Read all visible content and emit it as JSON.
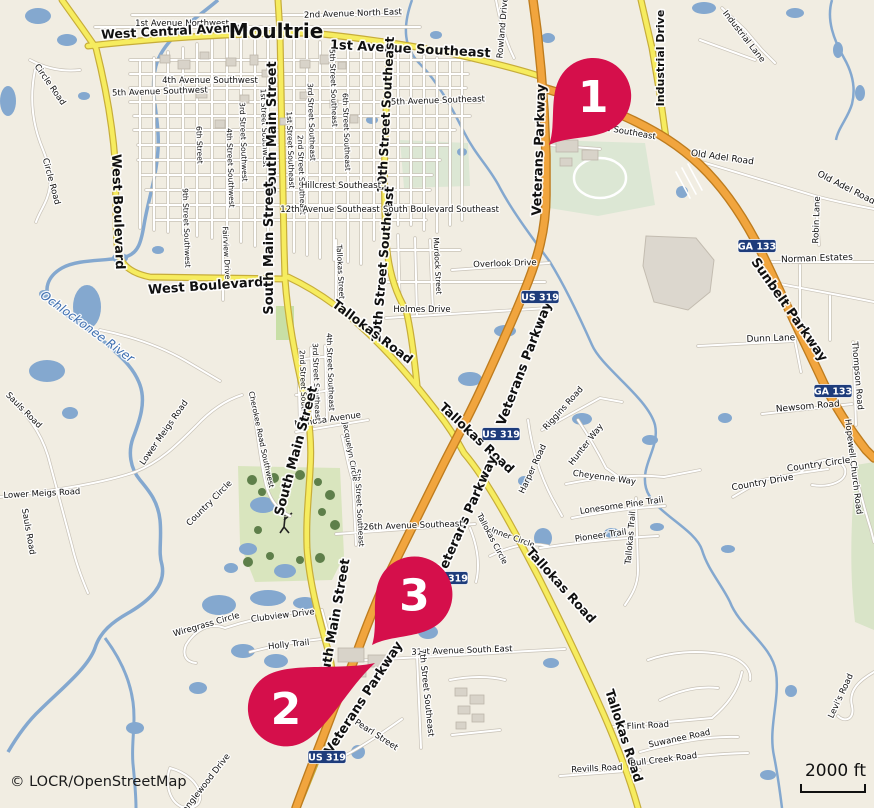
{
  "attribution": "© LOCR/OpenStreetMap",
  "scale": {
    "label": "2000 ft"
  },
  "colors": {
    "land": "#F1EDE2",
    "water": "#84A8CF",
    "road_minor_fill": "#FFFFFF",
    "road_minor_casing": "#C9C3B8",
    "road_secondary_fill": "#F6EC5F",
    "road_secondary_casing": "#C7AD3A",
    "road_trunk_fill": "#F1A53E",
    "road_trunk_casing": "#BE7C1E",
    "green_golf": "#D9E5BE",
    "green_park": "#DCE7D4",
    "tree": "#5E7F4A",
    "building": "#D8D3C9",
    "industrial": "#DCD7CE",
    "shield": "#1E3C7B",
    "marker": "#D50F4B",
    "label_text": "#101010",
    "water_text": "#3D6EB0"
  },
  "markers": [
    {
      "number": "1",
      "tip": [
        549,
        145
      ],
      "rot": 42,
      "len": 66
    },
    {
      "number": "2",
      "tip": [
        375,
        663
      ],
      "rot": -117,
      "len": 100
    },
    {
      "number": "3",
      "tip": [
        372,
        645
      ],
      "rot": 40,
      "len": 66
    }
  ],
  "shields": [
    {
      "label": "US 319",
      "x": 540,
      "y": 297
    },
    {
      "label": "US 319",
      "x": 501,
      "y": 434
    },
    {
      "label": "US 319",
      "x": 449,
      "y": 578
    },
    {
      "label": "US 319",
      "x": 327,
      "y": 757
    },
    {
      "label": "GA 133",
      "x": 757,
      "y": 246
    },
    {
      "label": "GA 133",
      "x": 833,
      "y": 391
    }
  ],
  "road_labels": [
    {
      "t": "1st Avenue Northwest",
      "x": 182,
      "y": 26,
      "r": 0,
      "s": 8.5
    },
    {
      "t": "West Central Avenue",
      "x": 175,
      "y": 35,
      "r": -3,
      "s": 12.5,
      "b": 1
    },
    {
      "t": "Moultrie",
      "x": 276,
      "y": 38,
      "r": 0,
      "s": 20,
      "b": 1,
      "n": "city-label"
    },
    {
      "t": "2nd Avenue North East",
      "x": 353,
      "y": 16,
      "r": -2,
      "s": 8.5
    },
    {
      "t": "1st Avenue Southeast",
      "x": 410,
      "y": 53,
      "r": 3,
      "s": 13,
      "b": 1
    },
    {
      "t": "Rowland Drive",
      "x": 505,
      "y": 28,
      "r": -85,
      "s": 8.5
    },
    {
      "t": "Industrial Drive",
      "x": 664,
      "y": 58,
      "r": -90,
      "s": 11,
      "b": 1
    },
    {
      "t": "Industrial Lane",
      "x": 742,
      "y": 38,
      "r": 52,
      "s": 8.5
    },
    {
      "t": "Old Adel Road",
      "x": 722,
      "y": 160,
      "r": 8,
      "s": 9
    },
    {
      "t": "Old Adel Road",
      "x": 845,
      "y": 190,
      "r": 27,
      "s": 9
    },
    {
      "t": "Robin Lane",
      "x": 819,
      "y": 220,
      "r": -88,
      "s": 8.5
    },
    {
      "t": "Norman Estates",
      "x": 817,
      "y": 261,
      "r": -2,
      "s": 9
    },
    {
      "t": "Sunbelt Parkway",
      "x": 786,
      "y": 312,
      "r": 55,
      "s": 13,
      "b": 1
    },
    {
      "t": "Dunn Lane",
      "x": 771,
      "y": 341,
      "r": -2,
      "s": 9
    },
    {
      "t": "Thompson Road",
      "x": 855,
      "y": 376,
      "r": 85,
      "s": 8.5
    },
    {
      "t": "Newsom Road",
      "x": 808,
      "y": 409,
      "r": -5,
      "s": 9
    },
    {
      "t": "Hopewell Church Road",
      "x": 851,
      "y": 467,
      "r": 83,
      "s": 8.5
    },
    {
      "t": "Country Circle",
      "x": 819,
      "y": 467,
      "r": -8,
      "s": 9
    },
    {
      "t": "Country Drive",
      "x": 763,
      "y": 485,
      "r": -10,
      "s": 9
    },
    {
      "t": "Levi's Road",
      "x": 843,
      "y": 697,
      "r": -65,
      "s": 8.5
    },
    {
      "t": "Circle Road",
      "x": 48,
      "y": 86,
      "r": 55,
      "s": 8.5
    },
    {
      "t": "Circle Road",
      "x": 49,
      "y": 182,
      "r": 75,
      "s": 8.5
    },
    {
      "t": "West Boulevard",
      "x": 114,
      "y": 212,
      "r": 88,
      "s": 13,
      "b": 1
    },
    {
      "t": "West Boulevard",
      "x": 206,
      "y": 290,
      "r": -4,
      "s": 13,
      "b": 1
    },
    {
      "t": "Ochlockonee River",
      "x": 85,
      "y": 330,
      "r": 36,
      "s": 12,
      "c": "#3D6EB0",
      "i": 1,
      "n": "river-label"
    },
    {
      "t": "Sauls Road",
      "x": 22,
      "y": 412,
      "r": 45,
      "s": 8.5
    },
    {
      "t": "Sauls Road",
      "x": 26,
      "y": 532,
      "r": 80,
      "s": 8.5
    },
    {
      "t": "Lower Meigs Road",
      "x": 166,
      "y": 434,
      "r": -55,
      "s": 8.5
    },
    {
      "t": "Lower Meigs Road",
      "x": 42,
      "y": 496,
      "r": -3,
      "s": 8.5
    },
    {
      "t": "Country Circle",
      "x": 211,
      "y": 505,
      "r": -45,
      "s": 8.5
    },
    {
      "t": "1st Street Southwest",
      "x": 262,
      "y": 128,
      "r": 88,
      "s": 7.5
    },
    {
      "t": "3rd Street Southwest",
      "x": 241,
      "y": 142,
      "r": 88,
      "s": 7.5
    },
    {
      "t": "4th Street Southwest",
      "x": 228,
      "y": 168,
      "r": 88,
      "s": 7.5
    },
    {
      "t": "6th Street",
      "x": 197,
      "y": 145,
      "r": 88,
      "s": 7.5
    },
    {
      "t": "9th Street Southwest",
      "x": 184,
      "y": 228,
      "r": 88,
      "s": 7.5
    },
    {
      "t": "1st Street Southeast",
      "x": 288,
      "y": 150,
      "r": 88,
      "s": 7.5
    },
    {
      "t": "2nd Street Southeast",
      "x": 299,
      "y": 175,
      "r": 88,
      "s": 7.5
    },
    {
      "t": "3rd Street Southeast",
      "x": 309,
      "y": 122,
      "r": 88,
      "s": 7.5
    },
    {
      "t": "5th Street Southeast",
      "x": 331,
      "y": 88,
      "r": 88,
      "s": 7.5
    },
    {
      "t": "6th Street Southeast",
      "x": 344,
      "y": 132,
      "r": 88,
      "s": 7.5
    },
    {
      "t": "10th Street Southeast",
      "x": 390,
      "y": 115,
      "r": -87,
      "s": 12.5,
      "b": 1
    },
    {
      "t": "10th Street Southeast",
      "x": 387,
      "y": 265,
      "r": -85,
      "s": 12.5,
      "b": 1
    },
    {
      "t": "South Main Street",
      "x": 276,
      "y": 128,
      "r": -90,
      "s": 13,
      "b": 1
    },
    {
      "t": "South Main Street",
      "x": 273,
      "y": 248,
      "r": -90,
      "s": 13,
      "b": 1
    },
    {
      "t": "4th Avenue Southwest",
      "x": 210,
      "y": 83,
      "r": 0,
      "s": 8.5
    },
    {
      "t": "5th Avenue Southwest",
      "x": 160,
      "y": 94,
      "r": -2,
      "s": 8.5
    },
    {
      "t": "5th Avenue Southeast",
      "x": 438,
      "y": 103,
      "r": -2,
      "s": 8.5
    },
    {
      "t": "Hillcrest Southeast",
      "x": 341,
      "y": 188,
      "r": 0,
      "s": 8.5
    },
    {
      "t": "12th Avenue Southeast",
      "x": 330,
      "y": 212,
      "r": 0,
      "s": 8.5
    },
    {
      "t": "South Boulevard Southeast",
      "x": 441,
      "y": 212,
      "r": 0,
      "s": 8.5
    },
    {
      "t": "nue Southeast",
      "x": 625,
      "y": 134,
      "r": 10,
      "s": 8.5
    },
    {
      "t": "Fairview Drive",
      "x": 224,
      "y": 253,
      "r": 87,
      "s": 7.5
    },
    {
      "t": "Tallokas Street",
      "x": 338,
      "y": 272,
      "r": 87,
      "s": 7.5
    },
    {
      "t": "Murdock Street",
      "x": 435,
      "y": 266,
      "r": 87,
      "s": 7.5
    },
    {
      "t": "Overlook Drive",
      "x": 505,
      "y": 266,
      "r": -2,
      "s": 8.5
    },
    {
      "t": "Holmes Drive",
      "x": 422,
      "y": 312,
      "r": 0,
      "s": 8.5
    },
    {
      "t": "Tallokas Road",
      "x": 370,
      "y": 335,
      "r": 37,
      "s": 12.5,
      "b": 1
    },
    {
      "t": "Veterans Parkway",
      "x": 543,
      "y": 150,
      "r": -88,
      "s": 13,
      "b": 1
    },
    {
      "t": "Veterans Parkway",
      "x": 528,
      "y": 365,
      "r": -69,
      "s": 13,
      "b": 1
    },
    {
      "t": "Tallokas Road",
      "x": 474,
      "y": 441,
      "r": 43,
      "s": 12.5,
      "b": 1
    },
    {
      "t": "Veterans Parkway",
      "x": 470,
      "y": 518,
      "r": -66,
      "s": 13,
      "b": 1
    },
    {
      "t": "Riggins Road",
      "x": 565,
      "y": 410,
      "r": -48,
      "s": 8.5
    },
    {
      "t": "Hunter Way",
      "x": 588,
      "y": 446,
      "r": -52,
      "s": 8.5
    },
    {
      "t": "Cheyenne Way",
      "x": 604,
      "y": 480,
      "r": 8,
      "s": 8.5
    },
    {
      "t": "Harper Road",
      "x": 535,
      "y": 470,
      "r": -65,
      "s": 8.5
    },
    {
      "t": "Lonesome Pine Trail",
      "x": 622,
      "y": 508,
      "r": -8,
      "s": 8.5
    },
    {
      "t": "Pioneer Trail",
      "x": 601,
      "y": 538,
      "r": -8,
      "s": 8.5
    },
    {
      "t": "Tallokas Trail",
      "x": 633,
      "y": 538,
      "r": -85,
      "s": 8.5
    },
    {
      "t": "Inner Circle",
      "x": 512,
      "y": 540,
      "r": 20,
      "s": 8
    },
    {
      "t": "Tallokas Circle",
      "x": 490,
      "y": 540,
      "r": 62,
      "s": 8
    },
    {
      "t": "26th Avenue Southeast",
      "x": 413,
      "y": 528,
      "r": -2,
      "s": 8.5
    },
    {
      "t": "5th Street Southeast",
      "x": 357,
      "y": 508,
      "r": 87,
      "s": 7.5
    },
    {
      "t": "Cherokee Road Southwest",
      "x": 259,
      "y": 440,
      "r": 78,
      "s": 7.5
    },
    {
      "t": "Mimosa Avenue",
      "x": 328,
      "y": 422,
      "r": -8,
      "s": 8.5
    },
    {
      "t": "Jacquelyn Circle",
      "x": 348,
      "y": 452,
      "r": 80,
      "s": 7.5
    },
    {
      "t": "2nd Street Southeast",
      "x": 301,
      "y": 390,
      "r": 88,
      "s": 7.5
    },
    {
      "t": "3rd Street Southeast",
      "x": 314,
      "y": 382,
      "r": 88,
      "s": 7.5
    },
    {
      "t": "4th Street Southeast",
      "x": 328,
      "y": 372,
      "r": 88,
      "s": 7.5
    },
    {
      "t": "South Main Street",
      "x": 300,
      "y": 452,
      "r": -75,
      "s": 13,
      "b": 1
    },
    {
      "t": "South Main Street",
      "x": 338,
      "y": 625,
      "r": -80,
      "s": 13,
      "b": 1
    },
    {
      "t": "Wiregrass Circle",
      "x": 207,
      "y": 627,
      "r": -16,
      "s": 8.5
    },
    {
      "t": "Clubview Drive",
      "x": 283,
      "y": 618,
      "r": -7,
      "s": 8.5
    },
    {
      "t": "Holly Trail",
      "x": 289,
      "y": 647,
      "r": -6,
      "s": 8.5
    },
    {
      "t": "31st Avenue South East",
      "x": 462,
      "y": 653,
      "r": -2,
      "s": 8.5
    },
    {
      "t": "7th Street Southeast",
      "x": 424,
      "y": 693,
      "r": 84,
      "s": 8.5
    },
    {
      "t": "Pearl Street",
      "x": 375,
      "y": 737,
      "r": 33,
      "s": 8.5
    },
    {
      "t": "Veterans Parkway",
      "x": 367,
      "y": 700,
      "r": -57,
      "s": 13,
      "b": 1
    },
    {
      "t": "Tanglewood Drive",
      "x": 207,
      "y": 786,
      "r": -52,
      "s": 8.5
    },
    {
      "t": "Tallokas Road",
      "x": 558,
      "y": 588,
      "r": 48,
      "s": 12.5,
      "b": 1
    },
    {
      "t": "Tallokas Road",
      "x": 620,
      "y": 737,
      "r": 72,
      "s": 12.5,
      "b": 1
    },
    {
      "t": "Flint Road",
      "x": 648,
      "y": 728,
      "r": -3,
      "s": 8.5
    },
    {
      "t": "Suwanee Road",
      "x": 680,
      "y": 741,
      "r": -12,
      "s": 8.5
    },
    {
      "t": "Bull Creek Road",
      "x": 664,
      "y": 762,
      "r": -7,
      "s": 8.5
    },
    {
      "t": "Revills Road",
      "x": 597,
      "y": 771,
      "r": -3,
      "s": 8.5
    }
  ]
}
